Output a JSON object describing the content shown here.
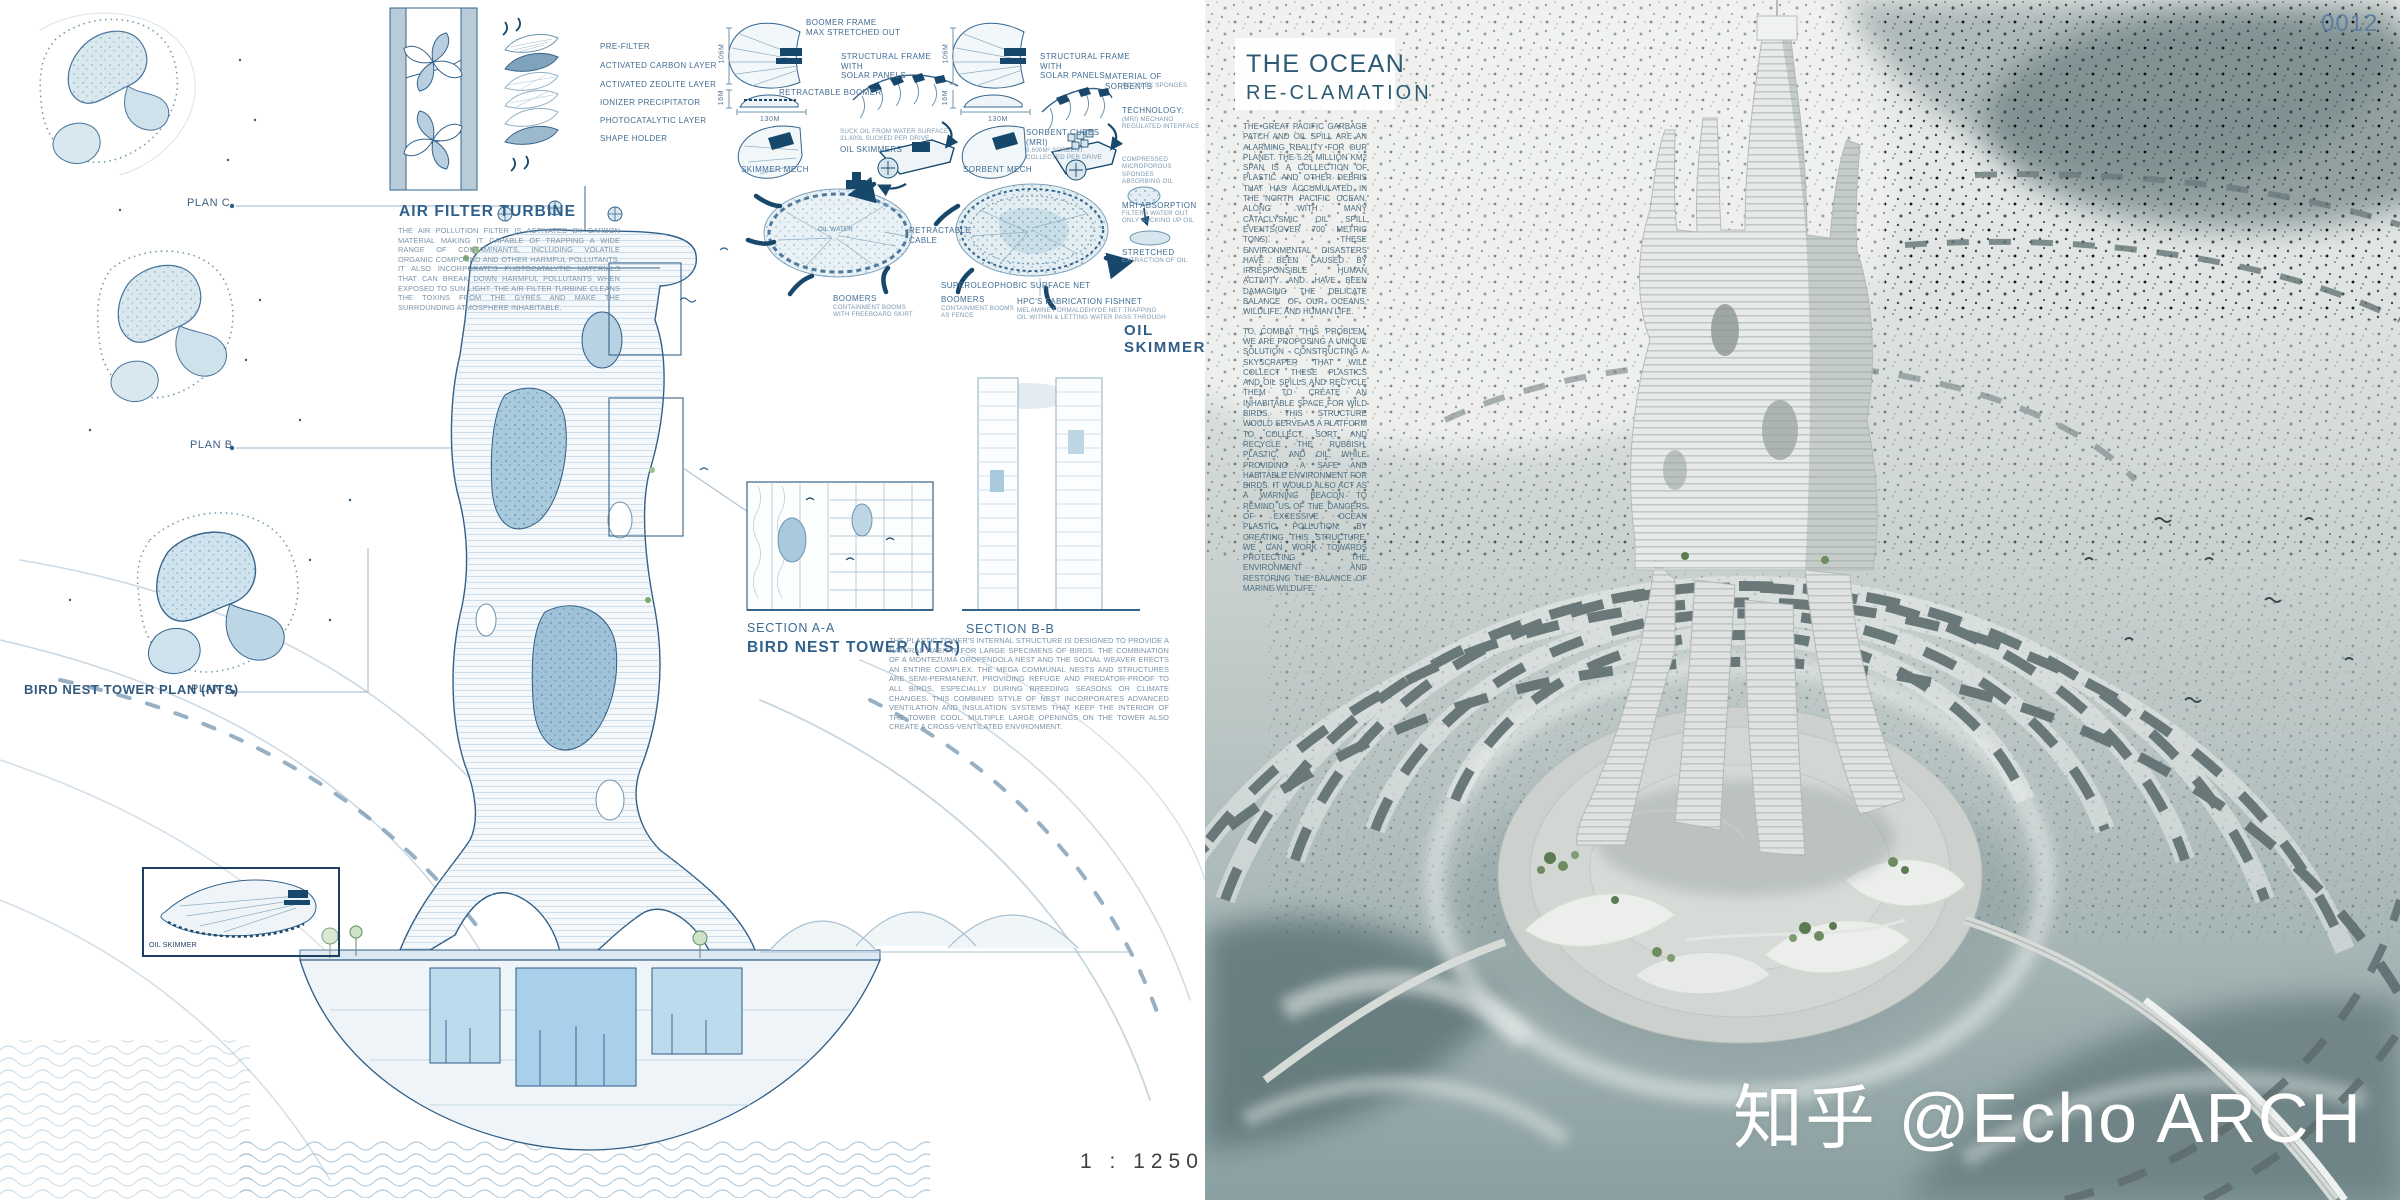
{
  "page": {
    "code": "0012",
    "scale": "1 : 1250",
    "watermark": "知乎 @Echo ARCH"
  },
  "filter_legend": [
    "PRE-FILTER",
    "ACTIVATED CARBON LAYER",
    "ACTIVATED ZEOLITE LAYER",
    "IONIZER PRECIPITATOR",
    "PHOTOCATALYTIC LAYER",
    "SHAPE HOLDER"
  ],
  "air_filter": {
    "title": "AIR FILTER TURBINE",
    "body": "THE AIR POLLUTION FILTER IS ACTIVATED BY CARBON MATERIAL MAKING IT CAPABLE OF TRAPPING A WIDE RANGE OF CONTAMINANTS, INCLUDING VOLATILE ORGANIC COMPOUND AND OTHER HARMFUL POLLUTANTS. IT ALSO INCORPORATES PHOTOCATALYTIC MATERIALS THAT CAN BREAK DOWN HARMFUL POLLUTANTS WHEN EXPOSED TO SUN LIGHT. THE AIR FILTER TURBINE CLEANS THE TOXINS FROM THE GYRES AND MAKE THE SURROUNDING ATMOSPHERE INHABITABLE."
  },
  "plans": {
    "plan_c": "PLAN C",
    "plan_b": "PLAN B",
    "plan_a": "PLAN A",
    "bird_nest": "BIRD NEST TOWER PLAN (NTS)"
  },
  "skimmer_diag": {
    "frame": "BOOMER FRAME\nMAX STRETCHED OUT",
    "h1": "106M",
    "h2": "16M",
    "w": "130M",
    "retract": "RETRACTABLE BOOMER",
    "solar": "STRUCTURAL FRAME\nWITH\nSOLAR PANELS",
    "suck_note": "SUCK OIL FROM WATER SURFACE\n31,600L SUCKED PER DRIVE",
    "skimmers": "OIL SKIMMERS",
    "mech": "SKIMMER MECH",
    "oil_water": "OIL WATER",
    "cable": "RETRACTABLE\nCABLE",
    "boomers": "BOOMERS",
    "boomers_note": "CONTAINMENT BOOMS\nWITH FREEBOARD SKIRT"
  },
  "sorbent_diag": {
    "h1": "106M",
    "h2": "16M",
    "w": "130M",
    "solar": "STRUCTURAL FRAME\nWITH\nSOLAR PANELS",
    "material": "MATERIAL OF SORBENTS",
    "material_note": "ECOFLEX SPONGES",
    "tech": "TECHNOLOGY:",
    "tech_note": "(MRI) MECHANO\nREGULATED INTERFACE",
    "cubes": "SORBENT CUBES\n(MRI)",
    "cubes_note": "9,600M³ SORBENT\nCOLLECTED PER DRIVE",
    "mech": "SORBENT MECH",
    "compressed": "COMPRESSED\nMICROPOROUS SPONGES\nABSORBING OIL",
    "absorb": "MRI ABSORPTION",
    "absorb_note": "FILTERS WATER OUT\nONLY SUCKING UP OIL",
    "stretched": "STRETCHED",
    "stretched_note": "EXTRACTION OF OIL",
    "surface_net": "SUPEROLEOPHOBIC SURFACE NET",
    "boomers": "BOOMERS",
    "boomers_note": "CONTAINMENT BOOMS\nAS FENCE",
    "fishnet": "HPC'S FABRICATION FISHNET",
    "fishnet_note": "MELAMINE FORMALDEHYDE NET TRAPPING\nOIL WITHIN & LETTING WATER PASS THROUGH",
    "title": "OIL SKIMMER"
  },
  "sections": {
    "a": "SECTION A-A",
    "b": "SECTION B-B",
    "title": "BIRD NEST TOWER (NTS)",
    "body": "THE PLASTIC TOWER'S INTERNAL STRUCTURE IS DESIGNED TO PROVIDE A NATURAL HABITAT FOR LARGE SPECIMENS OF BIRDS. THE COMBINATION OF A MONTEZUMA OROPENDOLA NEST AND THE SOCIAL WEAVER ERECTS AN ENTIRE COMPLEX. THE MEGA COMMUNAL NESTS AND STRUCTURES ARE SEMI-PERMANENT, PROVIDING REFUGE AND PREDATOR-PROOF TO ALL BIRDS, ESPECIALLY DURING BREEDING SEASONS OR CLIMATE CHANGES. THIS COMBINED STYLE OF NEST INCORPORATES ADVANCED VENTILATION AND INSULATION SYSTEMS THAT KEEP THE INTERIOR OF THE TOWER COOL. MULTIPLE LARGE OPENINGS ON THE TOWER ALSO CREATE A CROSS-VENTILATED ENVIRONMENT."
  },
  "oil_skimmer_box": "OIL SKIMMER",
  "right_panel": {
    "title1": "THE OCEAN",
    "title2": "RE-CLAMATION",
    "p1": "THE GREAT PACIFIC GARBAGE PATCH AND OIL SPILL ARE AN ALARMING REALITY FOR OUR PLANET. THE 5.25 MILLION KM2 SPAN IS A COLLECTION OF PLASTIC AND OTHER DEBRIS THAT HAS ACCUMULATED IN THE NORTH PACIFIC OCEAN, ALONG WITH MANY CATACLYSMIC OIL SPILL EVENTS(OVER 700 METRIC TONS). THESE ENVIRONMENTAL DISASTERS HAVE BEEN CAUSED BY IRRESPONSIBLE HUMAN ACTIVITY AND HAVE BEEN DAMAGING THE DELICATE BALANCE OF OUR OCEANS, WILDLIFE, AND HUMAN LIFE.",
    "p2": "TO COMBAT THIS PROBLEM, WE ARE PROPOSING A UNIQUE SOLUTION - CONSTRUCTING A SKYSCRAPER THAT WILL COLLECT THESE PLASTICS AND OIL SPILLS AND RECYCLE THEM TO CREATE AN INHABITABLE SPACE FOR WILD BIRDS. THIS STRUCTURE WOULD SERVE AS A PLATFORM TO COLLECT, SORT, AND RECYCLE THE RUBBISH, PLASTIC, AND OIL, WHILE PROVIDING A SAFE AND HABITABLE ENVIRONMENT FOR BIRDS. IT WOULD ALSO ACT AS A WARNING BEACON TO REMIND US OF THE DANGERS OF EXCESSIVE OCEAN PLASTIC POLLUTION. BY CREATING THIS STRUCTURE, WE CAN WORK TOWARDS PROTECTING THE ENVIRONMENT AND RESTORING THE BALANCE OF MARINE WILDLIFE."
  }
}
